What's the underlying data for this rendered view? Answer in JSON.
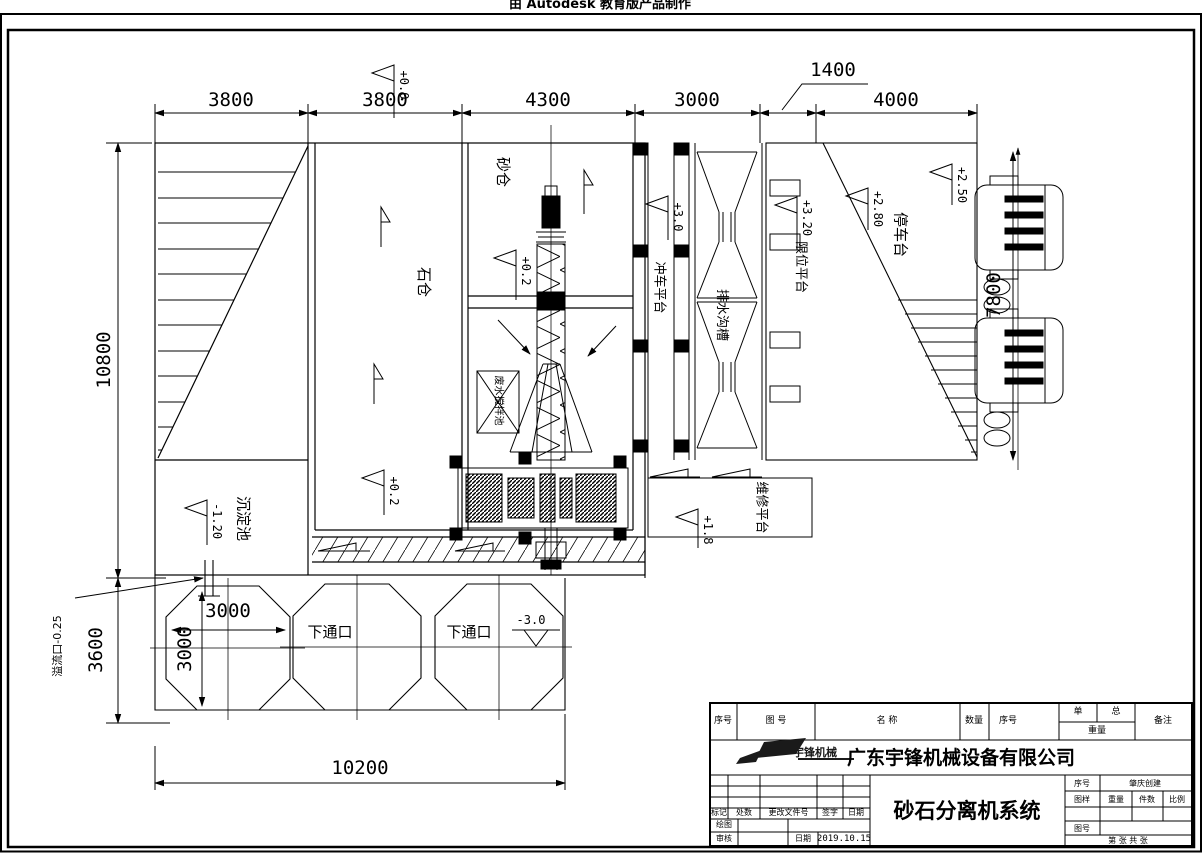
{
  "stamp": "由 Autodesk 教育版产品制作",
  "dims": {
    "top": [
      "3800",
      "3800",
      "4300",
      "3000",
      "1400",
      "4000"
    ],
    "left_upper": "10800",
    "left_lower": "3600",
    "bottom": "10200",
    "right": "7800",
    "pit_h": "3000",
    "pit_v": "3000"
  },
  "elev": {
    "top": "+0.0",
    "sand": "+0.2",
    "stone": "+0.2",
    "wash": "+3.0",
    "limit": "+3.20",
    "park_inner": "+2.80",
    "park_outer": "+2.50",
    "maint": "+1.8",
    "sediment": "-1.20",
    "pit": "-3.0"
  },
  "labels": {
    "sand_bin": "砂仓",
    "stone_bin": "石仓",
    "wash_platform": "冲车平台",
    "drain_channel": "排水沟槽",
    "limit_platform": "限位平台",
    "parking_platform": "停车台",
    "sediment_pool": "沉淀池",
    "maintenance_platform": "维修平台",
    "lower_port": "下通口",
    "overflow_port": "溢流口-0.25",
    "mix_pool": "废水搅拌池"
  },
  "titleblock": {
    "headers": {
      "seq": "序号",
      "drawing_no": "图  号",
      "name": "名  称",
      "qty": "数量",
      "seq2": "序号",
      "unit": "单",
      "total": "总",
      "weight": "重量",
      "remark": "备注"
    },
    "company": "广东宇锋机械设备有限公司",
    "logo_text": "宇锋机械",
    "title": "砂石分离机系统",
    "left": {
      "mark": "标记",
      "count": "处数",
      "change_doc": "更改文件号",
      "sign": "签字",
      "date": "日期",
      "draw": "绘图",
      "check": "审核",
      "date2": "日期",
      "date_value": "2019.10.15"
    },
    "right": {
      "seq": "序号",
      "seq_value": "肇庆创建",
      "sample": "图样",
      "weight": "重量",
      "qty": "件数",
      "scale": "比例",
      "fig_no": "图号",
      "sheet": "第   张   共   张"
    }
  }
}
